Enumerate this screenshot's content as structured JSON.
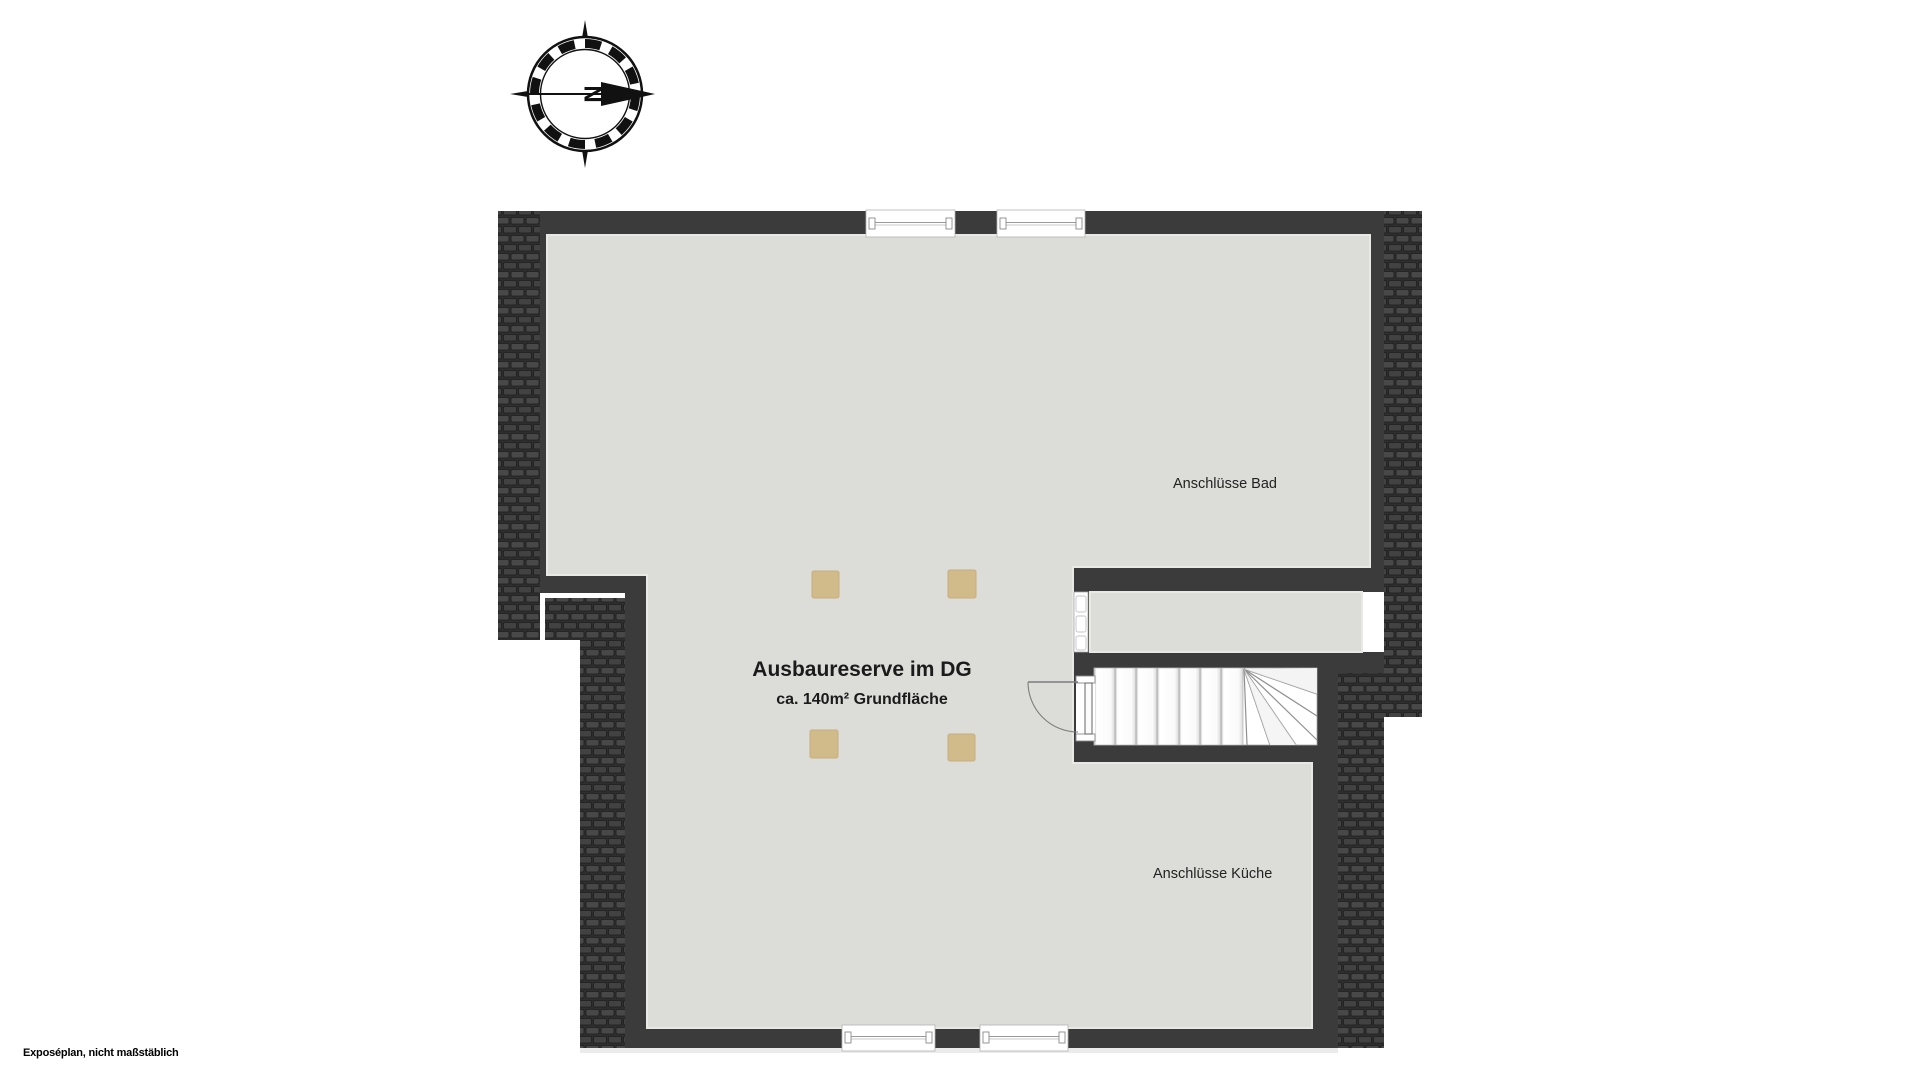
{
  "plan": {
    "title": "Ausbaureserve im DG",
    "subtitle": "ca. 140m² Grundfläche",
    "annotation_bath": "Anschlüsse Bad",
    "annotation_kitchen": "Anschlüsse Küche"
  },
  "compass": {
    "north_label": "N"
  },
  "footer": {
    "note": "Exposéplan, nicht maßstäblich"
  },
  "colors": {
    "wall": "#3b3b3b",
    "floor": "#dcdcd8",
    "roof_base": "#2e2e2e",
    "roof_tile": "#484848",
    "column": "#d2bb8b",
    "stair_edge": "#9a9a9a",
    "text": "#1b1b1b",
    "background": "#ffffff"
  }
}
